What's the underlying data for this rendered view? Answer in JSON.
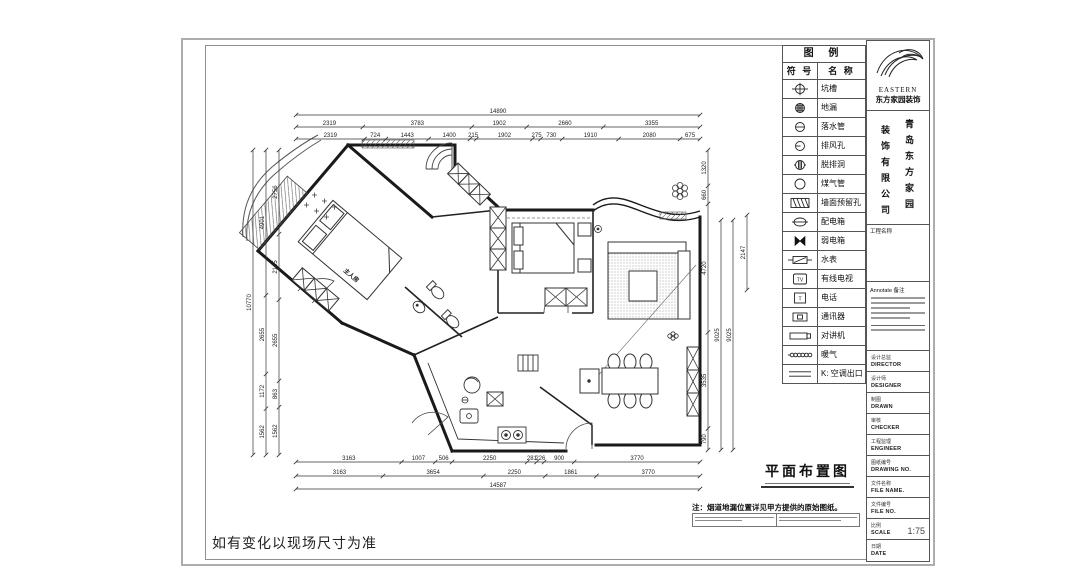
{
  "page": {
    "background": "#ffffff",
    "line_color": "#1a1a1a"
  },
  "plan": {
    "title": "平面布置图",
    "room_label": "主人房",
    "note": "注：烟道地漏位置详见甲方提供的原始图纸。",
    "site_note": "如有变化以现场尺寸为准"
  },
  "dims": {
    "top": {
      "overall": "14890",
      "row2": [
        "2319",
        "3783",
        "1902",
        "2660",
        "3355"
      ],
      "row3": [
        "2319",
        "724",
        "1443",
        "1400",
        "215",
        "1902",
        "275",
        "730",
        "1910",
        "2080",
        "675"
      ]
    },
    "left": {
      "overall": "10770",
      "mid": [
        "4901",
        "2655",
        "1172",
        "1562"
      ],
      "inner": [
        "2756",
        "2145",
        "2655",
        "863",
        "1562"
      ]
    },
    "right": {
      "chain": [
        "1320",
        "660",
        "4720",
        "3535",
        "790"
      ],
      "totals": [
        "9025",
        "9025"
      ],
      "extra": "2147"
    },
    "bottom": {
      "row1": [
        "3163",
        "1007",
        "506",
        "2250",
        "281",
        "226",
        "900",
        "3770"
      ],
      "row2": [
        "3163",
        "3654",
        "2250",
        "1861",
        "3770"
      ],
      "overall": "14587"
    }
  },
  "legend": {
    "title": "图 例",
    "col_symbol": "符 号",
    "col_name": "名 称",
    "rows": [
      {
        "icon": "crosshair-circle-icon",
        "label": "坑槽",
        "glyph": ""
      },
      {
        "icon": "hatched-circle-icon",
        "label": "地漏",
        "glyph": ""
      },
      {
        "icon": "circle-dash-icon",
        "label": "落水管",
        "glyph": ""
      },
      {
        "icon": "circle-halfline-icon",
        "label": "排风孔",
        "glyph": ""
      },
      {
        "icon": "vent-circle-icon",
        "label": "脱排洞",
        "glyph": ""
      },
      {
        "icon": "circle-icon",
        "label": "煤气管",
        "glyph": ""
      },
      {
        "icon": "hatched-rect-icon",
        "label": "墙面预留孔",
        "glyph": ""
      },
      {
        "icon": "stadium-dash-icon",
        "label": "配电箱",
        "glyph": ""
      },
      {
        "icon": "bowtie-icon",
        "label": "弱电箱",
        "glyph": ""
      },
      {
        "icon": "water-meter-icon",
        "label": "水表",
        "glyph": ""
      },
      {
        "icon": "tv-box-icon",
        "label": "有线电视",
        "glyph": "TV"
      },
      {
        "icon": "phone-box-icon",
        "label": "电话",
        "glyph": "T"
      },
      {
        "icon": "comm-box-icon",
        "label": "通讯器",
        "glyph": ""
      },
      {
        "icon": "intercom-icon",
        "label": "对讲机",
        "glyph": ""
      },
      {
        "icon": "radiator-icon",
        "label": "暖气",
        "glyph": ""
      },
      {
        "icon": "ac-outlet-icon",
        "label": "K: 空调出口",
        "glyph": ""
      }
    ]
  },
  "titleblock": {
    "logo_en": "EASTERN",
    "logo_cn": "东方家园装饰",
    "company_col_right": "青岛东方家园",
    "company_col_left": "装饰有限公司",
    "project_label": "工程名称",
    "annotate_label": "Annotate 备注",
    "rows": [
      {
        "cn": "设计总监",
        "en": "DIRECTOR",
        "value": ""
      },
      {
        "cn": "设计师",
        "en": "DESIGNER",
        "value": ""
      },
      {
        "cn": "制图",
        "en": "DRAWN",
        "value": ""
      },
      {
        "cn": "审核",
        "en": "CHECKER",
        "value": ""
      },
      {
        "cn": "工程监理",
        "en": "ENGINEER",
        "value": ""
      },
      {
        "cn": "图纸编号",
        "en": "DRAWING NO.",
        "value": ""
      },
      {
        "cn": "文件名称",
        "en": "FILE NAME.",
        "value": ""
      },
      {
        "cn": "文件编号",
        "en": "FILE NO.",
        "value": ""
      },
      {
        "cn": "比例",
        "en": "SCALE",
        "value": "1:75"
      },
      {
        "cn": "日期",
        "en": "DATE",
        "value": ""
      }
    ]
  }
}
